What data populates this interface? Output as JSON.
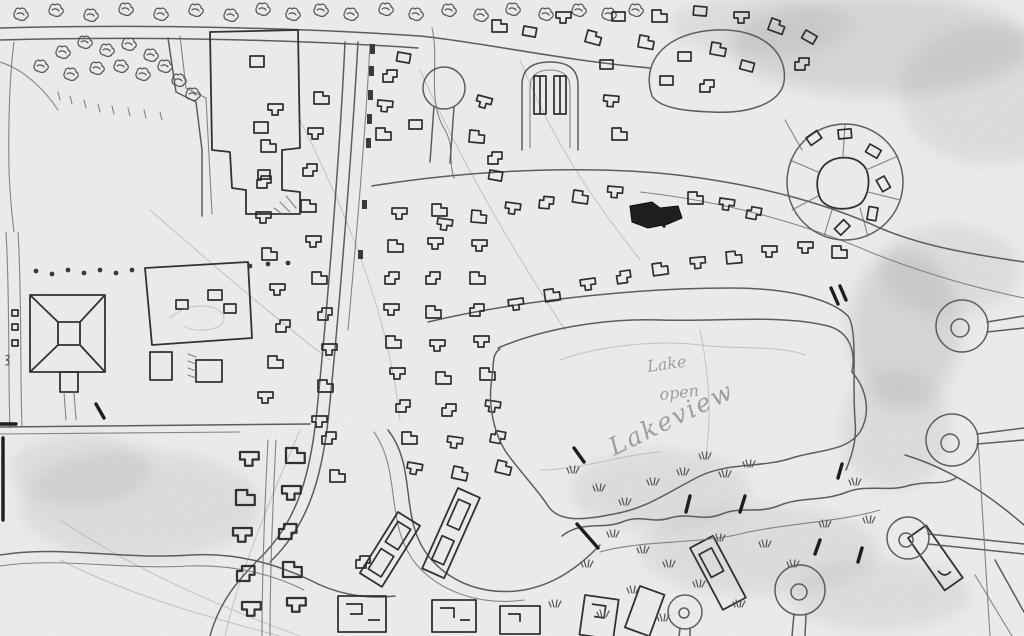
{
  "meta": {
    "title": "Hand-drawn neighborhood site plan sketch",
    "medium": "pencil sketch, photocopied (grayscale)"
  },
  "palette": {
    "paper": "#f1f0ee",
    "pencil": "#4a4a4a",
    "pencil_light": "#8a8a8a",
    "pencil_bold": "#1c1c1c",
    "shade": "#8d8d8d"
  },
  "handwriting": {
    "line1": "Lake",
    "line2": "open",
    "line3": "Lakeview"
  },
  "features": {
    "labels": [
      "tree-row-icon",
      "school-campus",
      "hip-roof-building",
      "walled-parcel",
      "main-road",
      "residential-houses",
      "keyhole-culdesac",
      "loop-road",
      "radial-court",
      "lake",
      "marsh-tufts",
      "lollipop-culdesacs",
      "rowhouse-street",
      "open-field",
      "vegetation-shading",
      "marked-dark-house"
    ]
  }
}
